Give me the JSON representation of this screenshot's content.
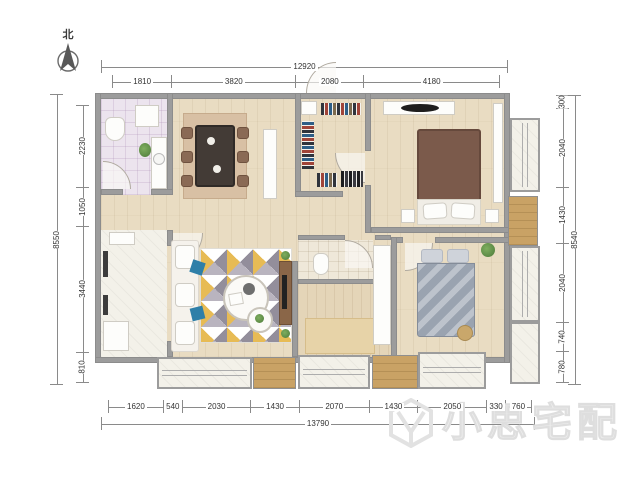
{
  "compass": {
    "label": "北"
  },
  "watermark": {
    "text": "小思宅配"
  },
  "dimensions": {
    "top": {
      "total": "12920",
      "segments": [
        "1810",
        "3820",
        "2080",
        "4180"
      ]
    },
    "bottom": {
      "total": "13790",
      "segments": [
        "1620",
        "540",
        "2030",
        "1430",
        "2070",
        "1430",
        "2050",
        "330",
        "760"
      ]
    },
    "left": {
      "total": "8550",
      "segments": [
        "2230",
        "1050",
        "3440",
        "810"
      ]
    },
    "right": {
      "total": "8540",
      "segments": [
        "300",
        "2040",
        "1430",
        "2040",
        "740",
        "780"
      ]
    }
  },
  "colors": {
    "wall": "#9c9c9c",
    "dimline": "#8a8a8a",
    "dimtext": "#333333",
    "wood": "#e9dcc2",
    "deck": "#c9a265",
    "ivory": "#f3f1e9",
    "tile1": "#ece4ee",
    "tile2": "#efe8d9",
    "study": "#e7d3a8",
    "ruggray": "#938e9b",
    "rugyellow": "#e7bb55",
    "blue": "#2e7fa8",
    "bedbrown": "#7b5a4b",
    "bedgray": "#9aa3b0",
    "tabledark": "#433b36",
    "console": "#8a6648",
    "wm": "#ececec"
  }
}
